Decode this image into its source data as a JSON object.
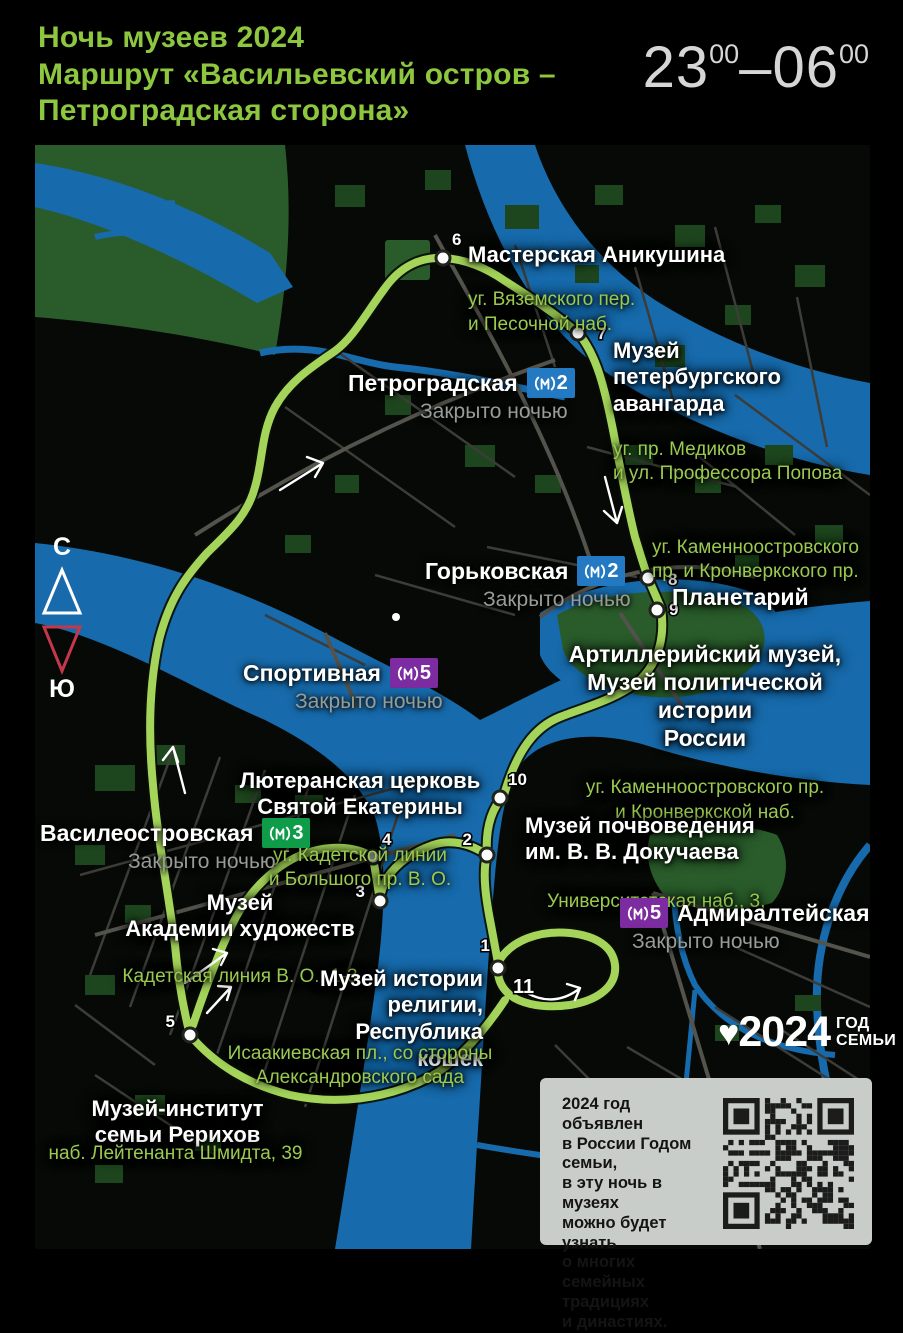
{
  "header": {
    "title": "Ночь музеев 2024\nМаршрут «Васильевский остров –\nПетроградская сторона»",
    "time": {
      "start_h": "23",
      "start_m": "00",
      "dash": "–",
      "end_h": "06",
      "end_m": "00"
    }
  },
  "compass": {
    "north": "С",
    "south": "Ю"
  },
  "metro": {
    "closed_label": "Закрыто ночью",
    "stations": [
      {
        "name": "Петроградская",
        "line": "2",
        "line_color": "#2379c2"
      },
      {
        "name": "Горьковская",
        "line": "2",
        "line_color": "#2379c2"
      },
      {
        "name": "Спортивная",
        "line": "5",
        "line_color": "#7c2ba0"
      },
      {
        "name": "Василеостровская",
        "line": "3",
        "line_color": "#0e9c48"
      },
      {
        "name": "Адмиралтейская",
        "line": "5",
        "line_color": "#7c2ba0"
      }
    ]
  },
  "museums": [
    {
      "name": "Мастерская Аникушина",
      "address": "уг. Вяземского пер.\nи Песочной наб."
    },
    {
      "name": "Музей\nпетербургского\nавангарда",
      "address": "уг. пр. Медиков\nи ул. Профессора Попова"
    },
    {
      "name": "Планетарий",
      "address": "уг. Каменноостровского\nпр. и Кронверкского пр."
    },
    {
      "name": "Артиллерийский музей,\nМузей политической истории\nРоссии",
      "address": "уг. Каменноостровского пр.\nи Кронверкской наб."
    },
    {
      "name": "Музей почвоведения\nим. В. В. Докучаева",
      "address": "Университетская наб., 3,"
    },
    {
      "name": "Лютеранская церковь\nСвятой Екатерины",
      "address": "уг. Кадетской линии\nи Большого пр. В. О."
    },
    {
      "name": "Музей\nАкадемии художеств",
      "address": "Кадетская линия В. О., 1-3"
    },
    {
      "name": "Музей истории\nрелигии,\nРеспублика кошек",
      "address": "Исаакиевская пл., со стороны\nАлександровского сада"
    },
    {
      "name": "Музей-институт\nсемьи Рерихов",
      "address": "наб. Лейтенанта Шмидта, 39"
    }
  ],
  "stop_numbers": [
    "1",
    "2",
    "3",
    "4",
    "5",
    "6",
    "7",
    "8",
    "9",
    "10",
    "11"
  ],
  "route_color": "#a4d55a",
  "water_color": "#176aab",
  "footer": {
    "logo": {
      "year": "2024",
      "line1": "ГОД",
      "line2": "СЕМЬИ"
    },
    "qr_text": "2024 год объявлен\nв России Годом семьи,\nв эту ночь в музеях\nможно будет узнать\nо многих семейных\nтрадициях\nи династиях."
  }
}
